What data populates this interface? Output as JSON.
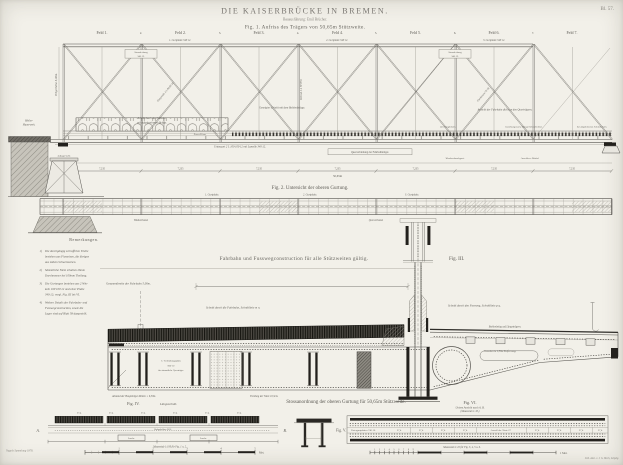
{
  "plate": {
    "number": "Bl. 57."
  },
  "title_block": {
    "title": "DIE KAISERBRÜCKE IN BREMEN.",
    "subtitle": "Bauausführung: Emil Brücher.",
    "fig1_caption": "Fig. 1. Aufriss des Trägers von 50,65m Stützweite."
  },
  "fig1": {
    "panel_labels": [
      "Feld 1.",
      "Feld 2.",
      "Feld 3.",
      "Feld 4.",
      "Feld 5.",
      "Feld 6.",
      "Feld 7."
    ],
    "post_numbers": [
      "2.",
      "3.",
      "4.",
      "5.",
      "6.",
      "7."
    ],
    "panel_dim": "7,235",
    "total_dim": "50,65m",
    "height_dim": "Trägerhöhe 5,00m.",
    "abutment_label_1": "Pfeiler-",
    "abutment_label_2": "Mauerwerk.",
    "bearing_label": "Auflagerstuhl.",
    "top_plate_labels": [
      "1. Gurtplatte 340·12.",
      "2. Gurtplatte 340·12.",
      "3. Gurtplatte 340·12."
    ],
    "stoss_box": [
      "Stossdeckung",
      "340·12."
    ],
    "railing_note_1": "Schnitt durch das Geländer",
    "railing_note_2": "mit aufgebrochenem Belage.",
    "deck_note_center": "Geneigter Schnitt mit dem Bohlenbelage.",
    "deck_note_right": "Ansicht der Fahrbahn dicht an den Querträgern.",
    "deck_row": [
      "mit Belagbohlen.",
      "beziehungsweise Belags-Schutzbohlen.",
      "bei abgehobenen Schutzbohlen."
    ],
    "diagonal_label_1": "Diagonale 2 L 80·80·10.",
    "diagonal_label_2": "Flacheisen 70·10.",
    "vertical_label": "Vertical 2 L 70·70·8.",
    "bottom_chord_label": "Untergurt 2 L 100·100·12 mit Lamelle 340·12.",
    "crossgirder_box": "Querverbindung der Fahrbahnträger.",
    "zores_label": "Zores-Eisen.",
    "wind_label_1": "Windverbandsgurt.",
    "wind_label_2": "Anschluss-Winkel."
  },
  "fig2": {
    "caption": "Fig. 2. Untersicht der oberen Gurtung.",
    "above_labels": [
      "1. Gurtplatte.",
      "2. Gurtplatte.",
      "3. Gurtplatte."
    ],
    "below_labels": [
      "Windverband.",
      "Querverband."
    ]
  },
  "notes": {
    "header": "Bemerkungen.",
    "items": [
      {
        "num": "1)",
        "lines": [
          "Die durchgängig schraffirten Theile",
          "bestehen aus Flusseisen, die übrigen",
          "aus zähem Schweisseisen."
        ]
      },
      {
        "num": "2)",
        "lines": [
          "Sämmtliche Niete erhalten 26mm",
          "Durchmesser bei 100mm Theilung."
        ]
      },
      {
        "num": "3)",
        "lines": [
          "Die Gurtungen bestehen aus 2 Win-",
          "keln 100·100·12 und einer Platte",
          "340·12; vergl. Fig. III bis VI."
        ]
      },
      {
        "num": "4)",
        "lines": [
          "Weitere Details der Fahrbahn- und",
          "Fusswegconstruction, sowie die",
          "Lager sind auf Blatt 58 dargestellt."
        ]
      }
    ]
  },
  "fig3": {
    "section_caption": "Fahrbahn und Fusswegconstruction für alle Stützweiten gültig.",
    "label": "Fig. III.",
    "roadway_dim": "Gesammtbreite der Fahrbahn 5,00m.",
    "section_road": "Schnitt durch die Fahrbahn, Schnittlinie m n.",
    "section_foot": "Schnitt durch den Fussweg, Schnittlinie p q.",
    "slope_label_1": "Bohlenbelag auf Längsträgern.",
    "slope_label_2": "Consolen in 1,50m Entfernung."
  },
  "deck": {
    "plate_note": [
      "C. Verbindungsplatte",
      "800·10",
      "für sämmtliche Querträger."
    ],
    "girder_dim": "Abstand der Hauptträger-Mitten = 6,50m.",
    "mid_note": "Theilung der Niete 10,5cm.",
    "caption": "Stossanordnung der oberen Gurtung für 50,65m Stützweite."
  },
  "fig4": {
    "label": "Fig. IV.",
    "sub": "Längsschnitt.",
    "band_values": [
      "27,4",
      "27,4",
      "27,4",
      "27,4",
      "27,4",
      "27,4"
    ],
    "plank_note": "Belagbohlen 26/5.",
    "splice_note": "Lasche.",
    "mark_a": "A.",
    "mark_b": "B.",
    "scale_label": "Maassstab 1:100 für Fig. 1 u. 2.",
    "scale_numbers": [
      "1",
      "2",
      "3",
      "4",
      "5"
    ],
    "scale_end": "Met."
  },
  "fig5": {
    "label": "Fig. V."
  },
  "fig6": {
    "label": "Fig. VI.",
    "sub_1": "Untere Ansicht nach A. B.",
    "sub_2": "(Maassstab 1:10.)",
    "left_note": "Untergurtplatten 740·10.",
    "tick_values": [
      "27,4",
      "27,4",
      "27,4",
      "27,4",
      "27,4",
      "27,4",
      "27,4",
      "27,4"
    ],
    "center_note": "Anzahl der Niete 27.",
    "scale_label": "Maassstab 1:10 für Fig. 3, 4, 5 u. 6.",
    "scale_numbers": [
      "1",
      "2",
      "3",
      "4",
      "5",
      "6",
      "7",
      "8",
      "9"
    ],
    "scale_end": "1 Met."
  },
  "credits": {
    "left": "Nagels Sammlung 1878.",
    "right": "Lith. Anst. v. J. G. Bach, Leipzig."
  },
  "colors": {
    "paper": "#f2f0e9",
    "ink": "#4a4a48",
    "faded_ink": "#77746e",
    "masonry": "#b9b6ad"
  }
}
